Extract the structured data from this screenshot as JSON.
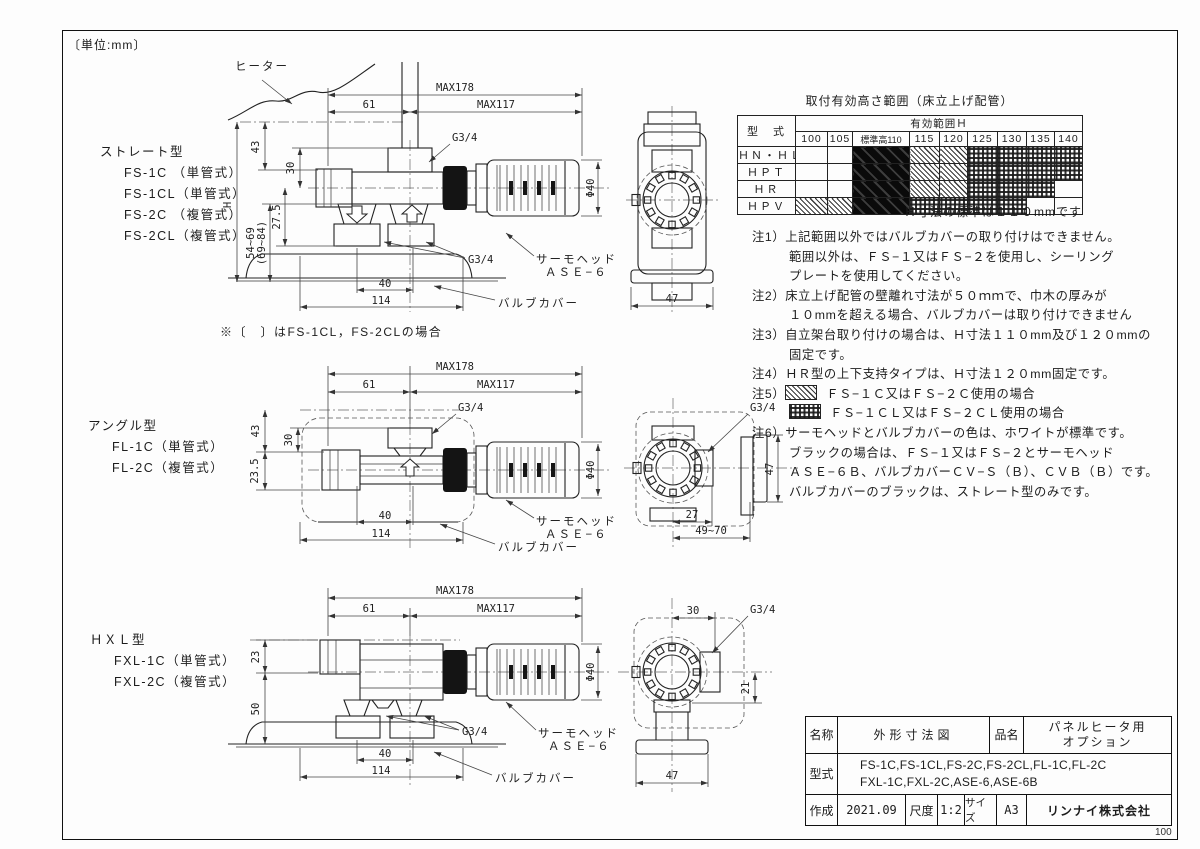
{
  "page": {
    "unit": "〔単位:mm〕",
    "page_num": "100"
  },
  "views": {
    "straight": {
      "type_label": "ストレート型",
      "models": [
        "FS-1C （単管式）",
        "FS-1CL（単管式）",
        "FS-2C （複管式）",
        "FS-2CL（複管式）"
      ],
      "bracket_note": "※〔　〕はFS-1CL，FS-2CLの場合",
      "heater_label": "ヒーター",
      "dims": {
        "H": "H",
        "h43": "43",
        "h30": "30",
        "h275": "27.5",
        "range": "54~69",
        "range2": "(69~84)",
        "w61": "61",
        "max178": "MAX178",
        "max117": "MAX117",
        "g34_top": "G3/4",
        "g34_bottom": "G3/4",
        "phi": "Φ40",
        "w40": "40",
        "w114": "114"
      },
      "thermo_line1": "サーモヘッド",
      "thermo_line2": "ＡＳＥ−６",
      "valve_cover": "バルブカバー",
      "side": {
        "w47": "47"
      }
    },
    "angle": {
      "type_label": "アングル型",
      "models": [
        "FL-1C（単管式）",
        "FL-2C（複管式）"
      ],
      "dims": {
        "h43": "43",
        "h30": "30",
        "h235": "23.5",
        "w61": "61",
        "max178": "MAX178",
        "max117": "MAX117",
        "g34_top": "G3/4",
        "phi": "Φ40",
        "w40": "40",
        "w114": "114"
      },
      "thermo_line1": "サーモヘッド",
      "thermo_line2": "ＡＳＥ−６",
      "valve_cover": "バルブカバー",
      "side": {
        "g34": "G3/4",
        "h47": "47",
        "w27": "27",
        "range": "49~70"
      }
    },
    "hxl": {
      "type_label": "ＨＸＬ型",
      "models": [
        "FXL-1C（単管式）",
        "FXL-2C（複管式）"
      ],
      "dims": {
        "h23": "23",
        "h50": "50",
        "w61": "61",
        "max178": "MAX178",
        "max117": "MAX117",
        "g34_bottom": "G3/4",
        "phi": "Φ40",
        "w40": "40",
        "w114": "114"
      },
      "thermo_line1": "サーモヘッド",
      "thermo_line2": "ＡＳＥ−６",
      "valve_cover": "バルブカバー",
      "side": {
        "w30": "30",
        "g34": "G3/4",
        "h21": "21",
        "w47": "47"
      }
    }
  },
  "table": {
    "title": "取付有効高さ範囲（床立上げ配管）",
    "model_header": "型　式",
    "range_header": "有効範囲Ｈ",
    "columns": [
      "100",
      "105",
      "標準高110",
      "115",
      "120",
      "125",
      "130",
      "135",
      "140"
    ],
    "rows": [
      {
        "model": "ＨＮ・ＨＬ",
        "cells": [
          "",
          "",
          "black",
          "hatch",
          "hatch",
          "checker",
          "checker",
          "checker",
          "checker"
        ]
      },
      {
        "model": "ＨＰＴ",
        "cells": [
          "",
          "",
          "black",
          "hatch",
          "hatch",
          "checker",
          "checker",
          "checker",
          "checker"
        ]
      },
      {
        "model": "ＨＲ",
        "cells": [
          "",
          "",
          "black",
          "hatch",
          "hatch",
          "checker",
          "checker",
          "checker",
          ""
        ]
      },
      {
        "model": "ＨＰＶ",
        "cells": [
          "hatch",
          "hatch",
          "black",
          "checker",
          "checker",
          "checker",
          "checker",
          "",
          ""
        ]
      }
    ],
    "footnote": "Ｈ寸法の標準は１１０mmです"
  },
  "notes": {
    "n1_label": "注1）",
    "n1a": "上記範囲以外ではバルブカバーの取り付けはできません。",
    "n1b": "範囲以外は、ＦＳ−１又はＦＳ−２を使用し、シーリング",
    "n1c": "プレートを使用してください。",
    "n2_label": "注2）",
    "n2a": "床立上げ配管の壁離れ寸法が５０ｍｍで、巾木の厚みが",
    "n2b": "１０mmを超える場合、バルブカバーは取り付けできません",
    "n3_label": "注3）",
    "n3a": "自立架台取り付けの場合は、Ｈ寸法１１０mm及び１２０mmの",
    "n3b": "固定です。",
    "n4_label": "注4）",
    "n4a": "ＨＲ型の上下支持タイプは、Ｈ寸法１２０mm固定です。",
    "n5_label": "注5）",
    "n5a": "ＦＳ−１Ｃ又はＦＳ−２Ｃ使用の場合",
    "n5b": "ＦＳ−１ＣＬ又はＦＳ−２ＣＬ使用の場合",
    "n6_label": "注6）",
    "n6a": "サーモヘッドとバルブカバーの色は、ホワイトが標準です。",
    "n6b": "ブラックの場合は、ＦＳ−１又はＦＳ−２とサーモヘッド",
    "n6c": "ＡＳＥ−６Ｂ、バルブカバーＣＶ−Ｓ（Ｂ）、ＣＶＢ（Ｂ）です。",
    "n6d": "バルブカバーのブラックは、ストレート型のみです。"
  },
  "title_block": {
    "name_label": "名称",
    "name_value": "外形寸法図",
    "item_label": "品名",
    "item_line1": "パネルヒータ用",
    "item_line2": "オプション",
    "model_label": "型式",
    "model_line1": "FS-1C,FS-1CL,FS-2C,FS-2CL,FL-1C,FL-2C",
    "model_line2": "FXL-1C,FXL-2C,ASE-6,ASE-6B",
    "date_label": "作成",
    "date_value": "2021.09",
    "scale_label": "尺度",
    "scale_value": "1:2",
    "size_label": "サイズ",
    "size_value": "A3",
    "company": "リンナイ株式会社"
  }
}
